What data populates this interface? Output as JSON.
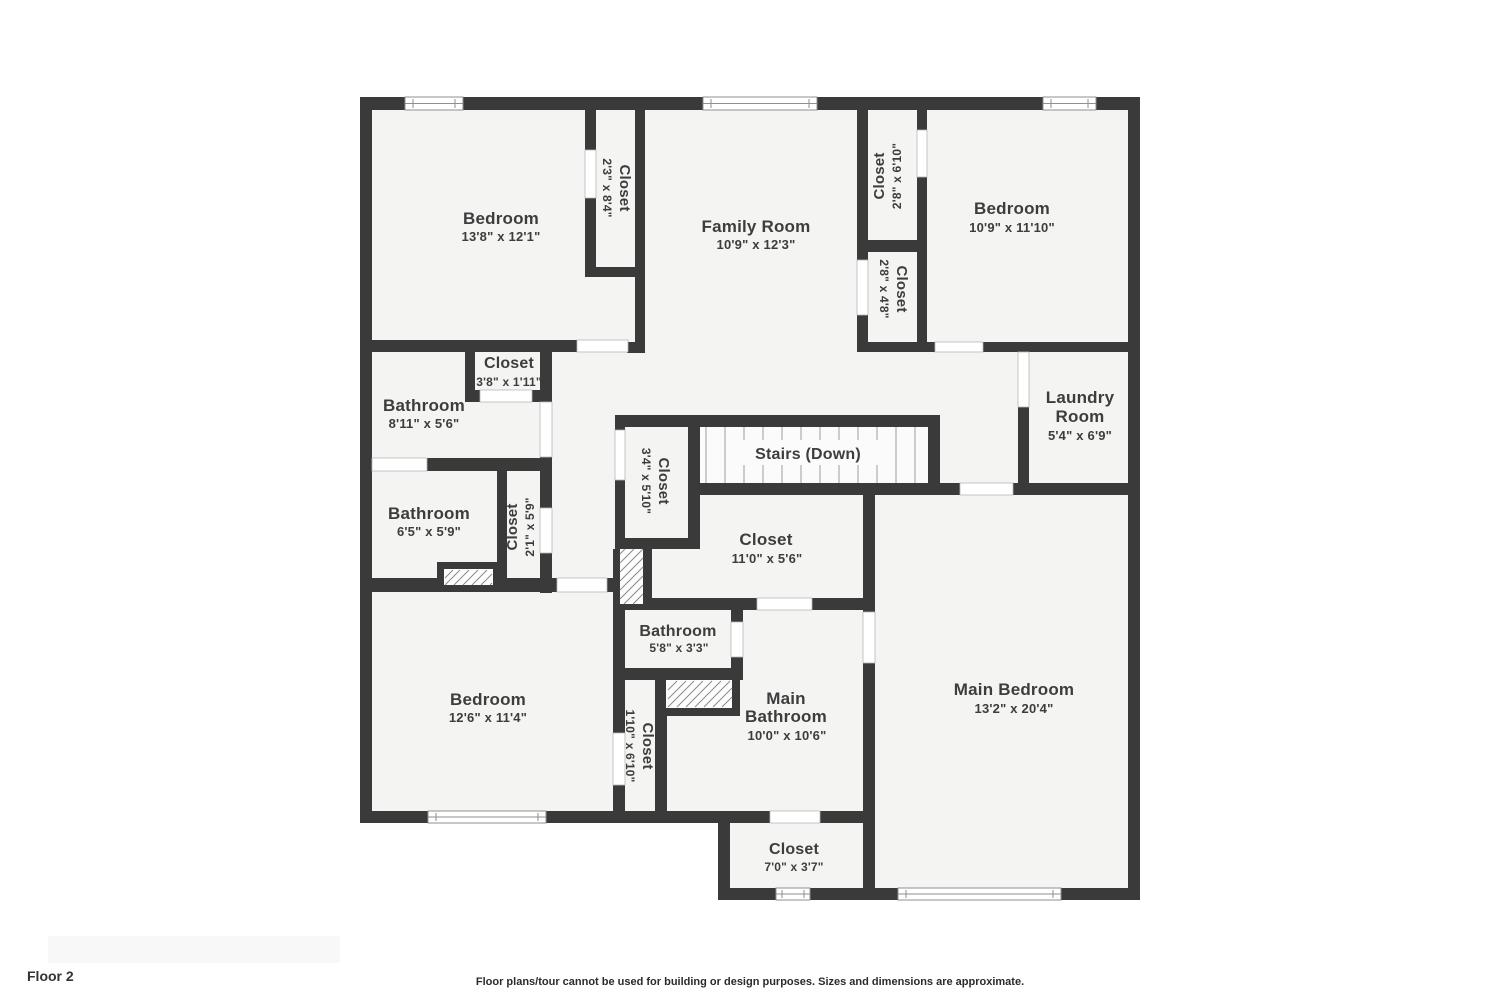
{
  "page": {
    "floor_label": "Floor 2",
    "disclaimer": "Floor plans/tour cannot be used for building or design purposes. Sizes and dimensions are approximate."
  },
  "colors": {
    "wall": "#3a3a3a",
    "room_fill": "#f4f4f3",
    "stairs_fill": "#fbfbfb"
  },
  "rooms": {
    "bedroom_tl": {
      "name": "Bedroom",
      "dims": "13'8\" x 12'1\""
    },
    "closet_tl": {
      "name": "Closet",
      "dims": "2'3\" x 8'4\""
    },
    "family_room": {
      "name": "Family Room",
      "dims": "10'9\" x 12'3\""
    },
    "closet_tr_upper": {
      "name": "Closet",
      "dims": "2'8\" x 6'10\""
    },
    "bedroom_tr": {
      "name": "Bedroom",
      "dims": "10'9\" x 11'10\""
    },
    "closet_tr_lower": {
      "name": "Closet",
      "dims": "2'8\" x 4'8\""
    },
    "closet_hall": {
      "name": "Closet",
      "dims": "3'8\" x 1'11\""
    },
    "bathroom_upper": {
      "name": "Bathroom",
      "dims": "8'11\" x 5'6\""
    },
    "laundry_room": {
      "line1": "Laundry",
      "line2": "Room",
      "dims": "5'4\" x 6'9\""
    },
    "stairs": {
      "name": "Stairs (Down)"
    },
    "closet_stairs": {
      "name": "Closet",
      "dims": "3'4\" x 5'10\""
    },
    "bathroom_mid": {
      "name": "Bathroom",
      "dims": "6'5\" x 5'9\""
    },
    "closet_mid": {
      "name": "Closet",
      "dims": "2'1\" x 5'9\""
    },
    "closet_center": {
      "name": "Closet",
      "dims": "11'0\" x 5'6\""
    },
    "bathroom_small": {
      "name": "Bathroom",
      "dims": "5'8\" x 3'3\""
    },
    "bedroom_bl": {
      "name": "Bedroom",
      "dims": "12'6\" x 11'4\""
    },
    "closet_bl": {
      "name": "Closet",
      "dims": "1'10\" x 6'10\""
    },
    "main_bathroom": {
      "line1": "Main",
      "line2": "Bathroom",
      "dims": "10'0\" x 10'6\""
    },
    "main_bedroom": {
      "name": "Main Bedroom",
      "dims": "13'2\" x 20'4\""
    },
    "closet_main": {
      "name": "Closet",
      "dims": "7'0\" x 3'7\""
    }
  }
}
